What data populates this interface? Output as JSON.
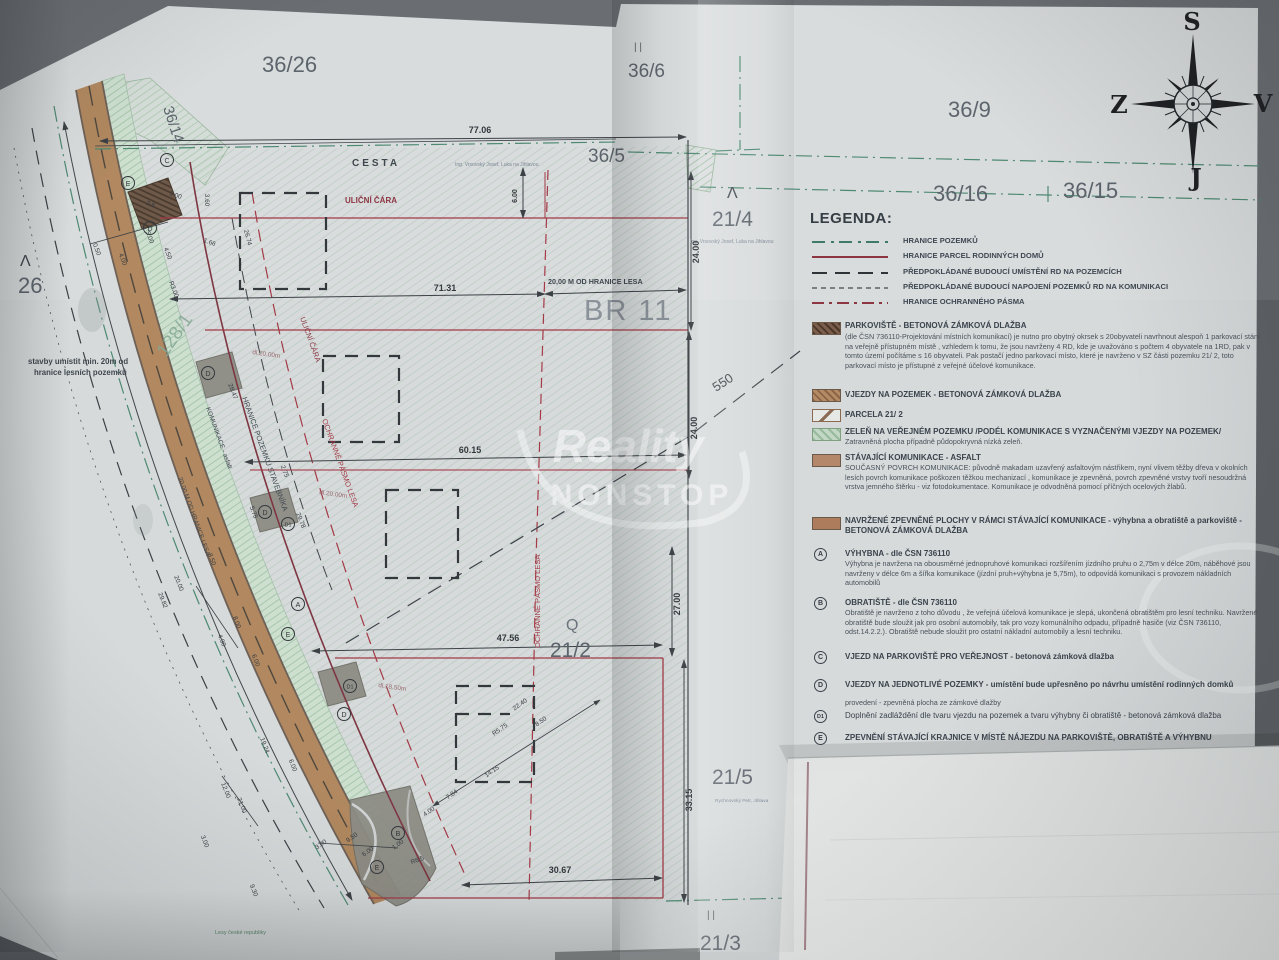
{
  "meta": {
    "watermark1": "Reality",
    "watermark2": "NONSTOP"
  },
  "compass": {
    "n": "S",
    "w": "Z",
    "e": "V",
    "s": "J"
  },
  "parcels": {
    "a36_26": "36/26",
    "a36_14": "36/14",
    "a36_6": "36/6",
    "a36_9": "36/9",
    "a36_16": "36/16",
    "a36_15": "36/15",
    "a36_5": "36/5",
    "a21_4": "21/4",
    "a21_2": "21/2",
    "a21_5": "21/5",
    "a21_3": "21/3",
    "a26": "26",
    "a128_1": "128/1",
    "br11": "BR 11",
    "d550": "550",
    "q": "Q",
    "lam1": "Λ",
    "lam2": "Λ",
    "par1": "| |",
    "par2": "| |"
  },
  "labels": {
    "cesta": "CESTA",
    "ulicni1": "ULIČNÍ ČÁRA",
    "ulicni2": "ULIČNÍ ČÁRA",
    "hranice_stav": "HRANICE POZEMKU STAVEBNÍKA",
    "ochranne1": "OCHRANNÉ PÁSMO LESA",
    "ochranne2": "OCHRANNÉ PÁSMO LESA",
    "komunikace": "KOMUNIKACE - asfalt",
    "od_lesa_rot": "20.00 M OD HRANICE LESA",
    "od_lesa_dim": "20,00 M OD HRANICE LESA",
    "note1": "stavby umístit min. 20m od",
    "note2": "hranice lesních pozemků",
    "lesy": "Lesy české republiky",
    "ing1": "Ing. Vrsovský Josef, Luka na Jihlavou",
    "ing2": "Ing. Vrsovský Josef, Luka na Jihlavou",
    "rychnovsky": "Rychnovský Petr, Jihlava"
  },
  "dims": {
    "d77": "77.06",
    "d71": "71.31",
    "d60": "60.15",
    "d47": "47.56",
    "d30": "30.67",
    "v24a": "24.00",
    "v24b": "24.00",
    "v27": "27.00",
    "v33": "33.15",
    "v6": "6.00",
    "small": [
      "0.50",
      "4.00",
      "5.00",
      "4.50",
      "2.6",
      "5.00",
      "3.60",
      "1.66",
      "R3.00",
      "26.74",
      "28.47",
      "dl.20.00m",
      "29.78",
      "2.75",
      "5.75",
      "dl.20.00m",
      "8.00",
      "4.90",
      "6.00",
      "20.00",
      "29.82",
      "19.24",
      "6.00",
      "21.00",
      "12.00",
      "3.00",
      "9.30",
      "dl.18.50m",
      "3.00",
      "9.50",
      "6.00",
      "1.00",
      "4.00",
      "7.84",
      "14.15",
      "22.40",
      "8.50",
      "R5.75",
      "R6.5",
      "8.50"
    ]
  },
  "plan_points": [
    "C",
    "E",
    "D",
    "D",
    "D",
    "D1",
    "A",
    "E",
    "D1",
    "D",
    "B",
    "E"
  ],
  "legend": {
    "title": "LEGENDA:",
    "lines": [
      {
        "label": "HRANICE POZEMKŮ"
      },
      {
        "label": "HRANICE PARCEL RODINNÝCH DOMŮ"
      },
      {
        "label": "PŘEDPOKLÁDANÉ BUDOUCÍ UMÍSTĚNÍ RD NA POZEMCÍCH"
      },
      {
        "label": "PŘEDPOKLÁDANÉ BUDOUCÍ NAPOJENÍ POZEMKŮ RD NA KOMUNIKACI"
      },
      {
        "label": "HRANICE OCHRANNÉHO PÁSMA"
      }
    ],
    "areas": [
      {
        "title": "PARKOVIŠTĚ - BETONOVÁ ZÁMKOVÁ DLAŽBA",
        "body": "(dle ČSN 736110-Projektování místních komunikací) je nutno pro obytný okrsek s 20obyvateli navrhnout alespoň 1 parkovací stání na veřejně přístupném místě , vzhledem k tomu, že jsou navrženy 4 RD, kde je uvažováno s počtem 4 obyvatele na 1RD, pak v tomto území počítáme s 16 obyvateli. Pak postačí jedno parkovací místo, které je navrženo v SZ části pozemku 21/ 2, toto parkovací místo je přístupné z veřejné účelové komunikace."
      },
      {
        "title": "VJEZDY NA POZEMEK - BETONOVÁ ZÁMKOVÁ DLAŽBA",
        "body": ""
      },
      {
        "title": "PARCELA 21/ 2",
        "body": ""
      },
      {
        "title": "ZELEŇ NA VEŘEJNÉM POZEMKU /PODÉL KOMUNIKACE S VYZNAČENÝMI VJEZDY NA POZEMEK/",
        "body": "Zatravněná plocha případně půdopokryvná nízká zeleň."
      },
      {
        "title": "STÁVAJÍCÍ KOMUNIKACE - ASFALT",
        "body": "SOUČASNÝ POVRCH KOMUNIKACE: původně makadam uzavřený asfaltovým nástřikem, nyní vlivem těžby dřeva v okolních lesích povrch komunikace  poškozen těžkou mechanizací , komunikace je zpevněná, povrch zpevněné vrstvy tvoří nesoudržná vrstva jemného štěrku - viz fotodokumentace. Komunikace je odvodněná pomocí příčných ocelových žlabů."
      },
      {
        "title": "NAVRŽENÉ ZPEVNĚNÉ PLOCHY V RÁMCI STÁVAJÍCÍ KOMUNIKACE - výhybna a obratiště a parkoviště - BETONOVÁ ZÁMKOVÁ DLAŽBA",
        "body": ""
      }
    ],
    "points": [
      {
        "key": "A",
        "title": "VÝHYBNA - dle ČSN 736110",
        "body": "Výhybna je navržena na obousměrné jednopruhové komunikaci rozšířením jízdního pruhu o 2,75m v délce 20m, náběhové jsou navrženy v délce 6m a šířka komunikace (jízdní pruh+výhybna je 5,75m), to odpovídá komunikaci s provozem nákladních automobilů"
      },
      {
        "key": "B",
        "title": "OBRATIŠTĚ - dle ČSN 736110",
        "body": "Obratiště je navrženo z toho důvodu , že veřejná účelová komunikace je slepá, ukončená obratištěm pro lesní techniku. Navržené obratiště bude sloužit jak pro osobní automobily, tak pro vozy komunálního odpadu, případně hasiče (viz ČSN 736110, odst.14.2.2.). Obratiště nebude sloužit pro ostatní nákladní automobily a lesní techniku."
      },
      {
        "key": "C",
        "title": "VJEZD NA PARKOVIŠTĚ PRO VEŘEJNOST - betonová zámková dlažba",
        "body": ""
      },
      {
        "key": "D",
        "title": "VJEZDY NA JEDNOTLIVÉ POZEMKY - umístění bude upřesněno po návrhu umístění rodinných domků",
        "body": "provedení - zpevněná plocha ze zámkové dlažby"
      },
      {
        "key": "D1",
        "title": "Doplnění zadláždění dle tvaru vjezdu na pozemek a tvaru výhybny či obratiště - betonová zámková dlažba",
        "body": ""
      },
      {
        "key": "E",
        "title": "ZPEVNĚNÍ STÁVAJÍCÍ KRAJNICE V MÍSTĚ  NÁJEZDU NA PARKOVIŠTĚ, OBRATIŠTĚ A VÝHYBNU",
        "body": ""
      }
    ]
  }
}
